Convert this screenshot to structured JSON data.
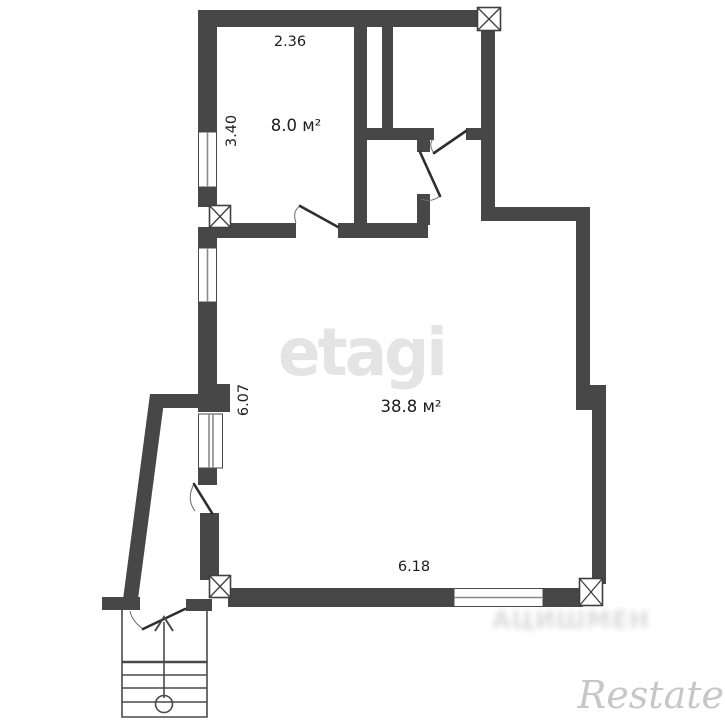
{
  "labels": {
    "room1_width": "2.36",
    "room1_depth": "3.40",
    "room1_area": "8.0 м²",
    "room2_depth": "6.07",
    "room2_area": "38.8 м²",
    "room2_width": "6.18"
  },
  "watermarks": {
    "brand": "etagi",
    "corner": "Restate",
    "blurred": "АЦИШМЕН"
  },
  "colors": {
    "wall": "#474747",
    "background": "#ffffff",
    "label_text": "#1d1d1d",
    "watermark_center": "#e4e4e4",
    "watermark_corner": "#c7c7c7"
  }
}
